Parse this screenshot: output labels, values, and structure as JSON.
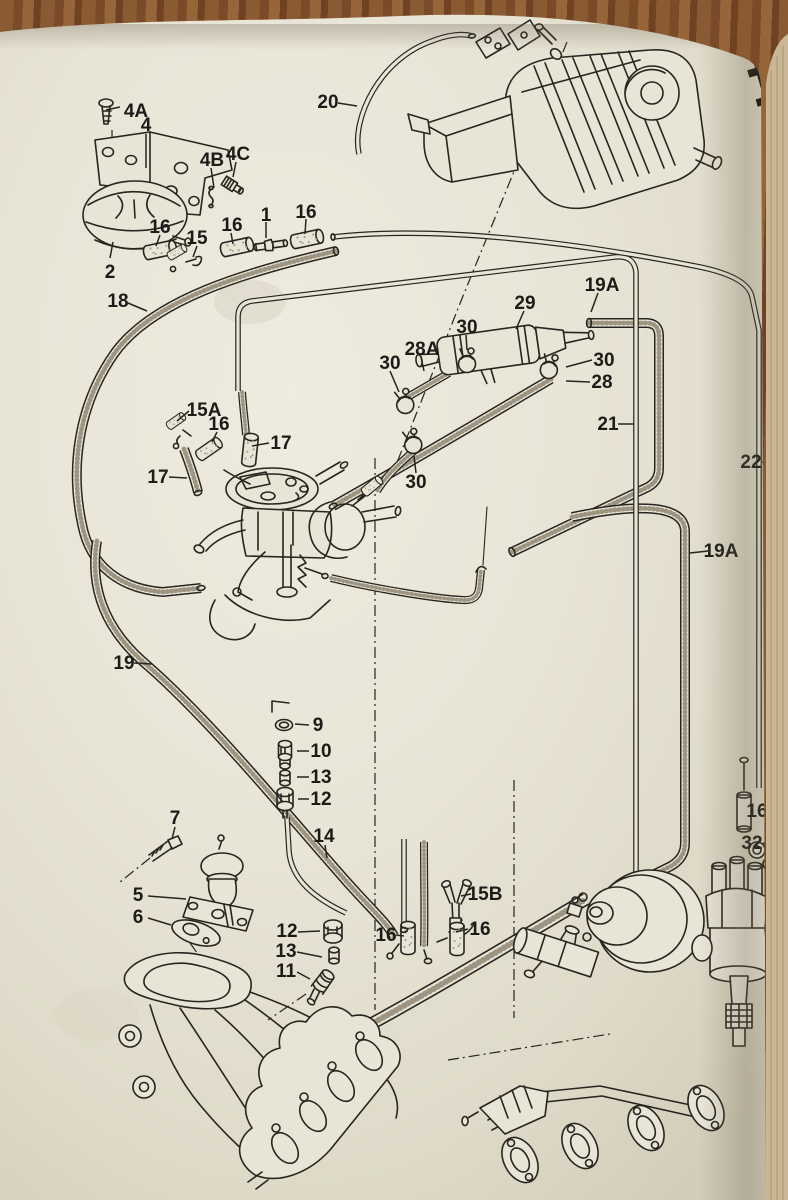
{
  "page": {
    "number": "44"
  },
  "colors": {
    "paper": "#e8e4d6",
    "paper_edge": "#c9b795",
    "wood": "#85572f",
    "ink": "#26251f",
    "stipple": "#9d9581",
    "label": "#1c1b17"
  },
  "callouts": {
    "c4A": "4A",
    "c4": "4",
    "c4B": "4B",
    "c4C": "4C",
    "c2": "2",
    "c16a": "16",
    "c15": "15",
    "c16b": "16",
    "c1": "1",
    "c16c": "16",
    "c18": "18",
    "c20": "20",
    "c15A": "15A",
    "c16d": "16",
    "c17a": "17",
    "c17b": "17",
    "c29": "29",
    "c19Aa": "19A",
    "c30a": "30",
    "c28A": "28A",
    "c30b": "30",
    "c30c": "30",
    "c28": "28",
    "c21": "21",
    "c22": "22",
    "c19Ab": "19A",
    "c30d": "30",
    "c19": "19",
    "c9": "9",
    "c10": "10",
    "c13a": "13",
    "c12a": "12",
    "c14": "14",
    "c7": "7",
    "c5": "5",
    "c6": "6",
    "c12b": "12",
    "c13b": "13",
    "c11": "11",
    "c15B": "15B",
    "c16e": "16",
    "c16f": "16",
    "c16g": "16",
    "c32": "32"
  }
}
